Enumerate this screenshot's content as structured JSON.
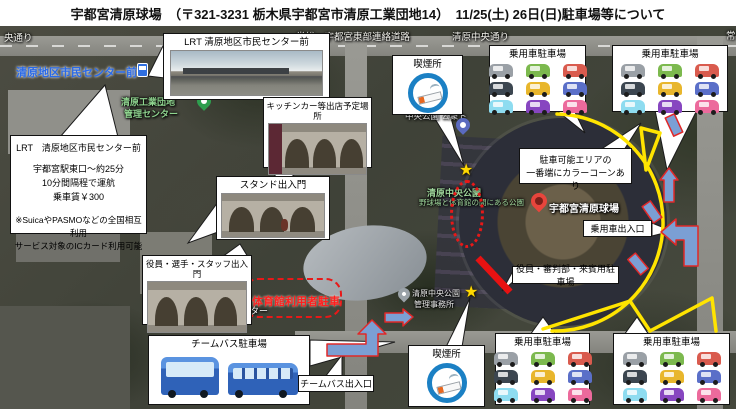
{
  "header": {
    "title": "宇都宮清原球場　（〒321-3231 栃木県宇都宮市清原工業団地14）　11/25(土) 26日(日)駐車場等について"
  },
  "roads": {
    "left_partial": "央通り",
    "joso": "常総・宇都宮東部連絡道路",
    "chuo": "清原中央通り",
    "right_partial": "常"
  },
  "map_labels": {
    "bus_stop": "清原地区市民センター前",
    "kogyo_line1": "清原工業団地",
    "kogyo_line2": "管理センター",
    "toilet": "中央公園 公衆ト",
    "park_name": "清原中央公園",
    "park_desc": "野球場と体育館の間にある公園",
    "stadium": "宇都宮清原球場",
    "civic_line1": "市清原",
    "civic_line2": "民センター",
    "gym_parking": "体育館利用者駐車",
    "office_line1": "清原中央公園",
    "office_line2": "管理事務所"
  },
  "callouts": {
    "lrt_info": {
      "title": "LRT　清原地区市民センター前",
      "line1": "宇都宮駅東口～約25分",
      "line2": "10分間隔程で運航",
      "line3": "乗車賃￥300",
      "note1": "※SuicaやPASMOなどの全国相互利用",
      "note2": "サービス対象のICカード利用可能"
    },
    "lrt_photo": {
      "title": "LRT 清原地区市民センター前"
    },
    "kitchen_car": {
      "title": "キッチンカー等出店予定場所"
    },
    "stand_gate": {
      "title": "スタンド出入門"
    },
    "staff_gate": {
      "title": "役員・選手・スタッフ出入門"
    },
    "smoking": {
      "title": "喫煙所"
    },
    "cone": {
      "line1": "駐車可能エリアの",
      "line2": "一番端にカラーコーンあり"
    },
    "car_gate": {
      "title": "乗用車出入口"
    },
    "vip_parking": {
      "title": "役員・審判部・来賓用駐車場"
    },
    "team_bus": {
      "title": "チームバス駐車場"
    },
    "team_bus_gate": {
      "title": "チームバス出入口"
    },
    "passenger_parking": {
      "title": "乗用車駐車場",
      "car_colors": [
        "#9aa0a6",
        "#7cb94e",
        "#d95b4e",
        "#3c4650",
        "#e8b62c",
        "#5a6fc8",
        "#8edcf0",
        "#8746c0",
        "#ec6a9c"
      ]
    }
  },
  "colors": {
    "route_yellow": "#ffe400",
    "arrow_blue": "#7b9fd4",
    "arrow_outline_red": "#e02828",
    "highlight_red": "#e81818",
    "smoking_blue": "#1b80c4",
    "star_yellow": "#ffd900",
    "pin_red": "#e8453c",
    "pin_blue": "#5a6abf",
    "pin_green": "#2e9e4e",
    "label_blue": "#2a6ae8",
    "label_green": "#8fd48f",
    "bus_blue": "#2f62b8"
  }
}
